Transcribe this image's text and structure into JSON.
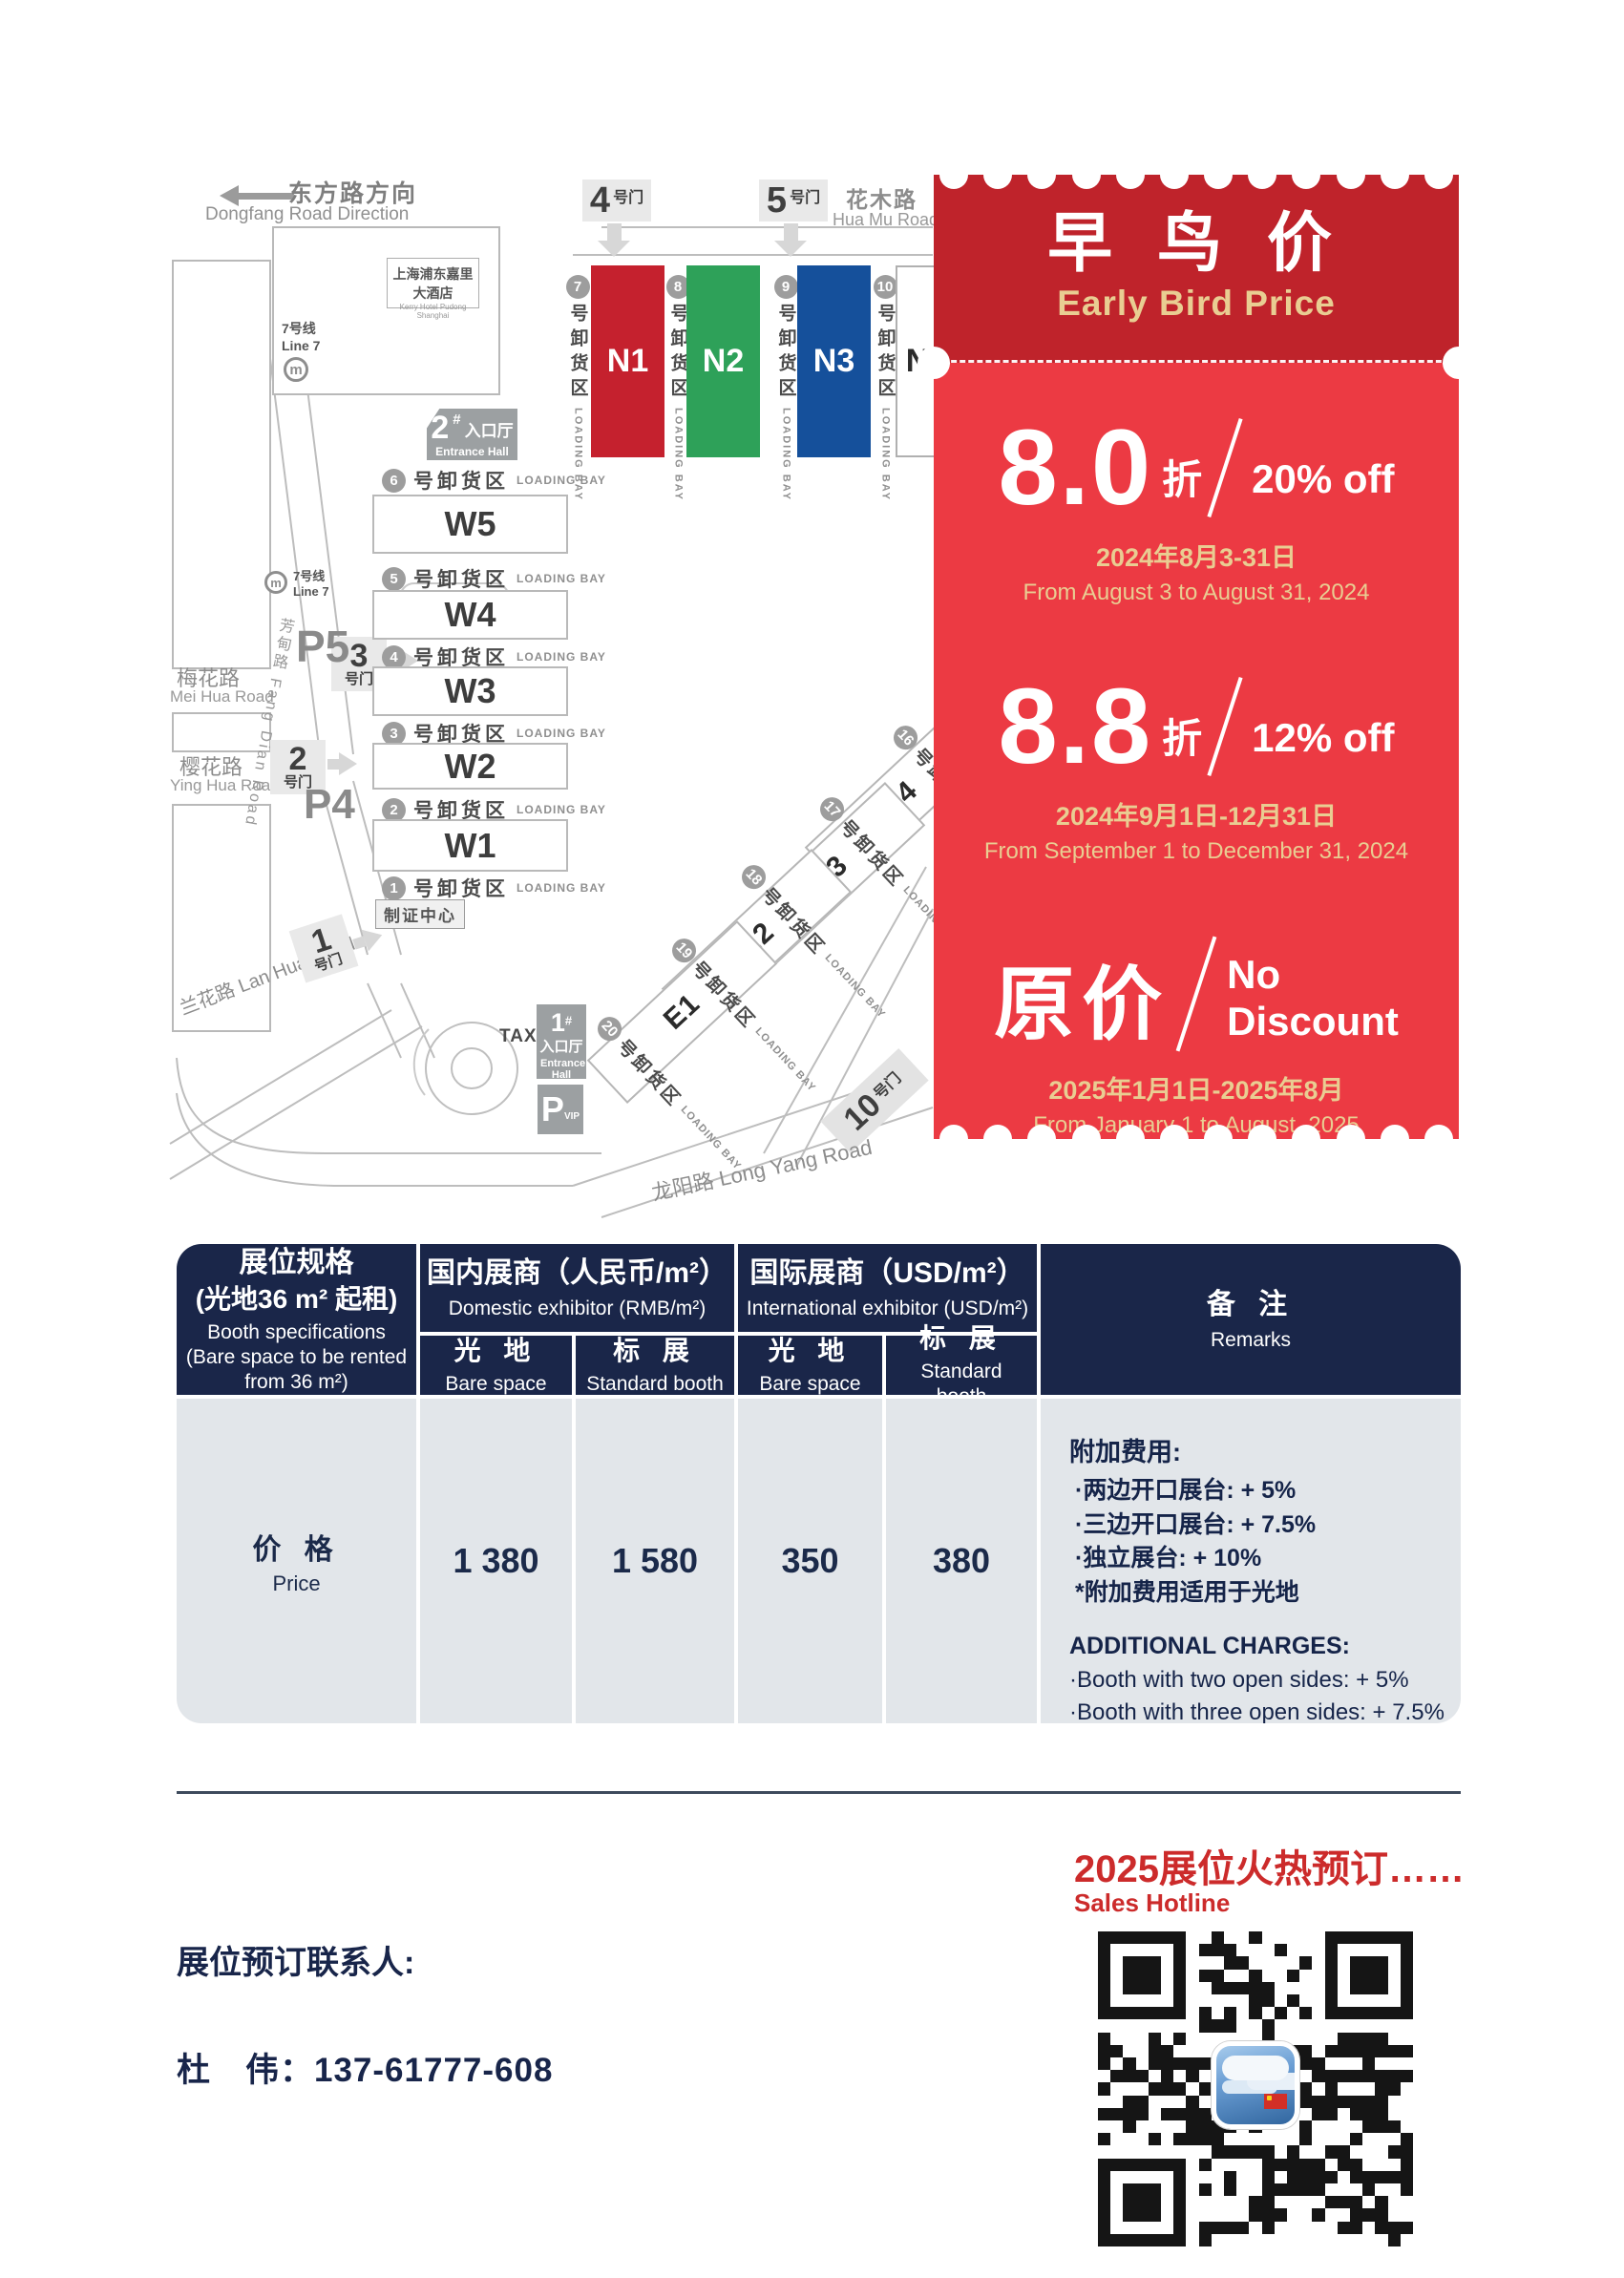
{
  "map": {
    "direction_zh": "东方路方向",
    "direction_en": "Dongfang Road Direction",
    "huamu_zh": "花木路",
    "huamu_en": "Hua Mu Road",
    "meihua_zh": "梅花路",
    "meihua_en": "Mei Hua Road",
    "yinghua_zh": "樱花路",
    "yinghua_en": "Ying Hua Road",
    "lanhua": "兰花路 Lan Hua Road",
    "fangdian": "芳甸路 Fang Dian Road",
    "longyang": "龙阳路  Long Yang Road",
    "line7_zh": "7号线",
    "line7_en": "Line 7",
    "hotel_zh": "上海浦东嘉里大酒店",
    "hotel_en": "Kerry Hotel Pudong Shanghai",
    "taxi": "TAXI",
    "zhizheng": "制证中心",
    "entrance_zh": "入口厅",
    "entrance_en": "Entrance Hall",
    "entrance2_num": "2",
    "entrance1_num": "1",
    "hash": "#",
    "pvip_p": "P",
    "pvip_sub": "VIP",
    "parking": [
      "P6",
      "P5",
      "P4"
    ],
    "gate_suffix": "号门",
    "gates_top": [
      "4",
      "5"
    ],
    "gates_left": [
      "3",
      "2",
      "1"
    ],
    "gate10": "10",
    "bay_zh": "号卸货区",
    "bay_en": "LOADING BAY",
    "bays_n": [
      "7",
      "8",
      "9",
      "10"
    ],
    "bays_w": [
      "6",
      "5",
      "4",
      "3",
      "2",
      "1"
    ],
    "bays_e": [
      "16",
      "17",
      "18",
      "19",
      "20"
    ],
    "halls_n": [
      {
        "label": "N1",
        "color": "#C5212E"
      },
      {
        "label": "N2",
        "color": "#2EA159"
      },
      {
        "label": "N3",
        "color": "#15509B"
      },
      {
        "label": "N4",
        "color": "#FFFFFF"
      }
    ],
    "halls_w": [
      "W5",
      "W4",
      "W3",
      "W2",
      "W1"
    ],
    "halls_e": [
      "E4",
      "E3",
      "E2",
      "E1"
    ]
  },
  "ticket": {
    "title_zh": "早 鸟 价",
    "title_en": "Early Bird Price",
    "color_dark": "#BF232B",
    "color_light": "#EC3A43",
    "color_gold": "#E9CD92",
    "tiers": [
      {
        "num": "8.0",
        "unit": "折",
        "off": "20% off",
        "date_zh": "2024年8月3-31日",
        "date_en": "From August 3 to August 31, 2024"
      },
      {
        "num": "8.8",
        "unit": "折",
        "off": "12% off",
        "date_zh": "2024年9月1日-12月31日",
        "date_en": "From September 1 to December 31, 2024"
      },
      {
        "num": "原价",
        "off1": "No",
        "off2": "Discount",
        "date_zh": "2025年1月1日-2025年8月",
        "date_en": "From January 1 to August, 2025"
      }
    ]
  },
  "table": {
    "spec_zh1": "展位规格",
    "spec_zh2": "(光地36 m² 起租)",
    "spec_en1": "Booth specifications",
    "spec_en2": "(Bare space to be rented from 36 m²)",
    "domestic_zh": "国内展商（人民币/m²）",
    "domestic_en": "Domestic exhibitor (RMB/m²)",
    "intl_zh": "国际展商（USD/m²）",
    "intl_en": "International exhibitor (USD/m²)",
    "remarks_zh": "备 注",
    "remarks_en": "Remarks",
    "bare_zh": "光 地",
    "bare_en": "Bare space",
    "std_zh": "标 展",
    "std_en": "Standard booth",
    "price_zh": "价 格",
    "price_en": "Price",
    "values": [
      "1 380",
      "1 580",
      "350",
      "380"
    ],
    "remarks": {
      "zh_title": "附加费用:",
      "zh1": "·两边开口展台: + 5%",
      "zh2": "·三边开口展台: + 7.5%",
      "zh3": "·独立展台: + 10%",
      "zh4": "*附加费用适用于光地",
      "en_title": "ADDITIONAL CHARGES:",
      "en1": "·Booth with two open sides: + 5%",
      "en2": "·Booth with three open sides: + 7.5%",
      "en3": "·Independent booth: + 10%",
      "en4": "*Additional charges apply to bare space"
    }
  },
  "footer": {
    "hotline_zh": "2025展位火热预订……",
    "hotline_en": "Sales Hotline",
    "contact_label": "展位预订联系人:",
    "contact_phone": "杜　伟：137-61777-608"
  }
}
